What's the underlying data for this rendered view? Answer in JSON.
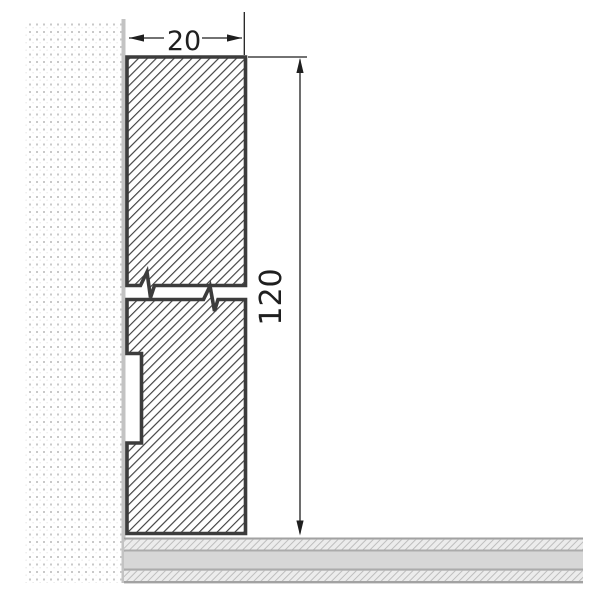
{
  "drawing": {
    "type": "technical-cross-section",
    "dimensions": {
      "width_label": "20",
      "height_label": "120"
    },
    "colors": {
      "background": "#ffffff",
      "profile_outline": "#3c3c3c",
      "profile_hatch_line": "#3f3f3f",
      "wall_dot": "#c9c9c9",
      "wall_face_line": "#c3c3c3",
      "dimension": "#1f1f1f",
      "floor_solid": "#d7d7d7",
      "floor_border": "#a2a2a2",
      "floor_hatch_bg": "#ececec",
      "floor_hatch_line": "#b9b9b9"
    }
  }
}
